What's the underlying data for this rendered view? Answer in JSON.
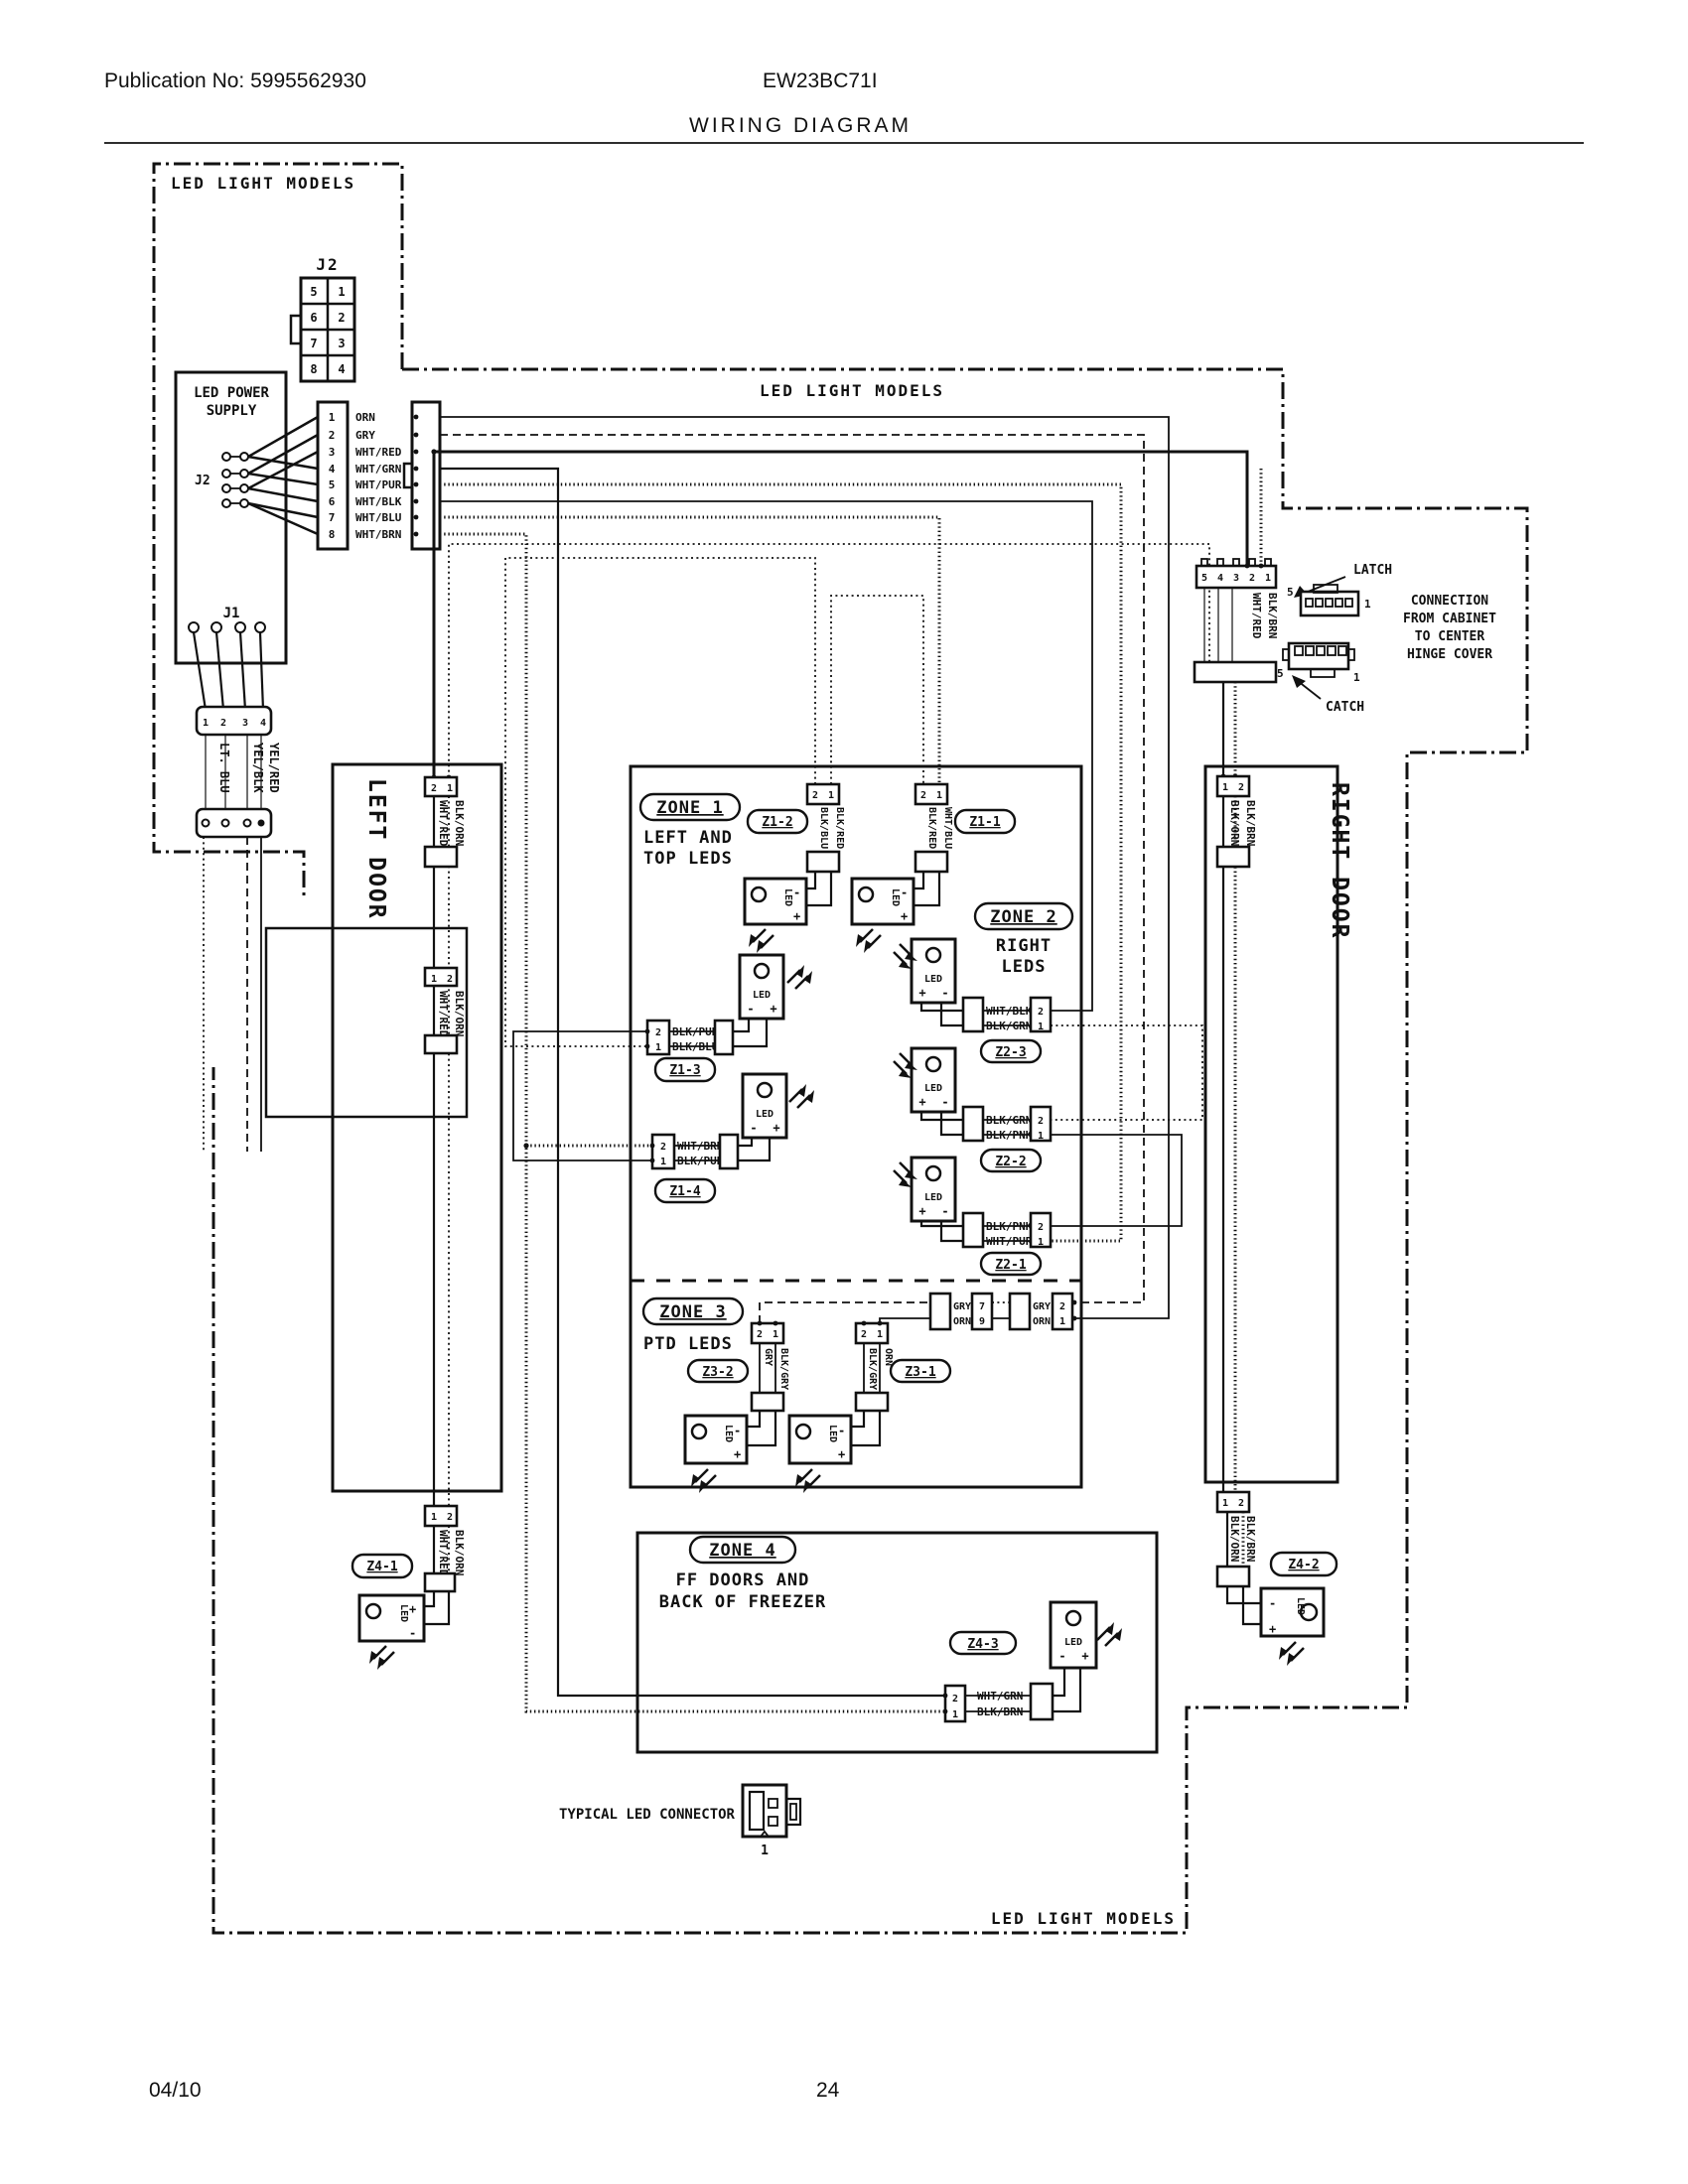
{
  "page": {
    "publication": "Publication No: 5995562930",
    "model": "EW23BC71I",
    "title": "WIRING DIAGRAM",
    "footer_date": "04/10",
    "footer_page": "24"
  },
  "region_label": "LED LIGHT MODELS",
  "power": {
    "title1": "LED POWER",
    "title2": "SUPPLY",
    "j2_name": "J2",
    "j1_name": "J1",
    "j2_cells": [
      "5",
      "1",
      "6",
      "2",
      "7",
      "3",
      "8",
      "4"
    ],
    "pins": [
      "1",
      "2",
      "3",
      "4",
      "5",
      "6",
      "7",
      "8"
    ],
    "wires": [
      "ORN",
      "GRY",
      "WHT/RED",
      "WHT/GRN",
      "WHT/PUR",
      "WHT/BLK",
      "WHT/BLU",
      "WHT/BRN"
    ],
    "j1_pins": [
      "1",
      "2",
      "3",
      "4"
    ],
    "j1_wires": [
      "LT. BLU",
      "YEL/BLK",
      "YEL/RED"
    ]
  },
  "hinge": {
    "pins": [
      "5",
      "4",
      "3",
      "2",
      "1"
    ],
    "wires": [
      "WHT/RED",
      "BLK/BRN"
    ],
    "latch": "LATCH",
    "catch": "CATCH",
    "latch_pin5": "5",
    "latch_pin1": "1",
    "catch_pin5": "5",
    "catch_pin1": "1",
    "note": [
      "CONNECTION",
      "FROM CABINET",
      "TO CENTER",
      "HINGE COVER"
    ]
  },
  "doors": {
    "left": "LEFT DOOR",
    "right": "RIGHT DOOR",
    "ld_top": {
      "pins": [
        "2",
        "1"
      ],
      "wires": [
        "WHT/RED",
        "BLK/ORN"
      ]
    },
    "ld_mid": {
      "pins": [
        "1",
        "2"
      ],
      "wires": [
        "WHT/RED",
        "BLK/ORN"
      ]
    },
    "rd_top": {
      "pins": [
        "1",
        "2"
      ],
      "wires": [
        "BLK/ORN",
        "BLK/BRN"
      ]
    }
  },
  "zones": {
    "z1": {
      "title": "ZONE 1",
      "sub1": "LEFT AND",
      "sub2": "TOP LEDS"
    },
    "z2": {
      "title": "ZONE 2",
      "sub1": "RIGHT",
      "sub2": "LEDS"
    },
    "z3": {
      "title": "ZONE 3",
      "sub1": "PTD LEDS"
    },
    "z4": {
      "title": "ZONE 4",
      "sub1": "FF DOORS AND",
      "sub2": "BACK OF FREEZER"
    }
  },
  "conn": {
    "z1_1": {
      "id": "Z1-1",
      "pins": [
        "2",
        "1"
      ],
      "wires": [
        "BLK/RED",
        "WHT/BLU"
      ]
    },
    "z1_2": {
      "id": "Z1-2",
      "pins": [
        "2",
        "1"
      ],
      "wires": [
        "BLK/BLU",
        "BLK/RED"
      ]
    },
    "z1_3": {
      "id": "Z1-3",
      "pins": [
        "2",
        "1"
      ],
      "wires": [
        "BLK/PUR",
        "BLK/BLU"
      ]
    },
    "z1_4": {
      "id": "Z1-4",
      "pins": [
        "2",
        "1"
      ],
      "wires": [
        "WHT/BRN",
        "BLK/PUR"
      ]
    },
    "z2_1": {
      "id": "Z2-1",
      "pins": [
        "2",
        "1"
      ],
      "wires": [
        "BLK/PNK",
        "WHT/PUR"
      ]
    },
    "z2_2": {
      "id": "Z2-2",
      "pins": [
        "2",
        "1"
      ],
      "wires": [
        "BLK/GRN",
        "BLK/PNK"
      ]
    },
    "z2_3": {
      "id": "Z2-3",
      "pins": [
        "2",
        "1"
      ],
      "wires": [
        "WHT/BLK",
        "BLK/GRN"
      ]
    },
    "z3_1": {
      "id": "Z3-1",
      "pins": [
        "2",
        "1"
      ],
      "wires": [
        "BLK/GRY",
        "ORN"
      ]
    },
    "z3_2": {
      "id": "Z3-2",
      "pins": [
        "2",
        "1"
      ],
      "wires": [
        "GRY",
        "BLK/GRY"
      ]
    },
    "z3_a": {
      "pins": [
        "7",
        "9"
      ],
      "wires": [
        "GRY",
        "ORN"
      ]
    },
    "z3_b": {
      "pins": [
        "2",
        "1"
      ],
      "wires": [
        "GRY",
        "ORN"
      ]
    },
    "z4_1": {
      "id": "Z4-1",
      "pins": [
        "1",
        "2"
      ],
      "wires": [
        "WHT/RED",
        "BLK/ORN"
      ]
    },
    "z4_2": {
      "id": "Z4-2",
      "pins": [
        "1",
        "2"
      ],
      "wires": [
        "BLK/ORN",
        "BLK/BRN"
      ]
    },
    "z4_3": {
      "id": "Z4-3",
      "pins": [
        "2",
        "1"
      ],
      "wires": [
        "WHT/GRN",
        "BLK/BRN"
      ]
    }
  },
  "led": {
    "label": "LED",
    "plus": "+",
    "minus": "-"
  },
  "typical": {
    "label": "TYPICAL LED CONNECTOR",
    "pin": "1"
  }
}
